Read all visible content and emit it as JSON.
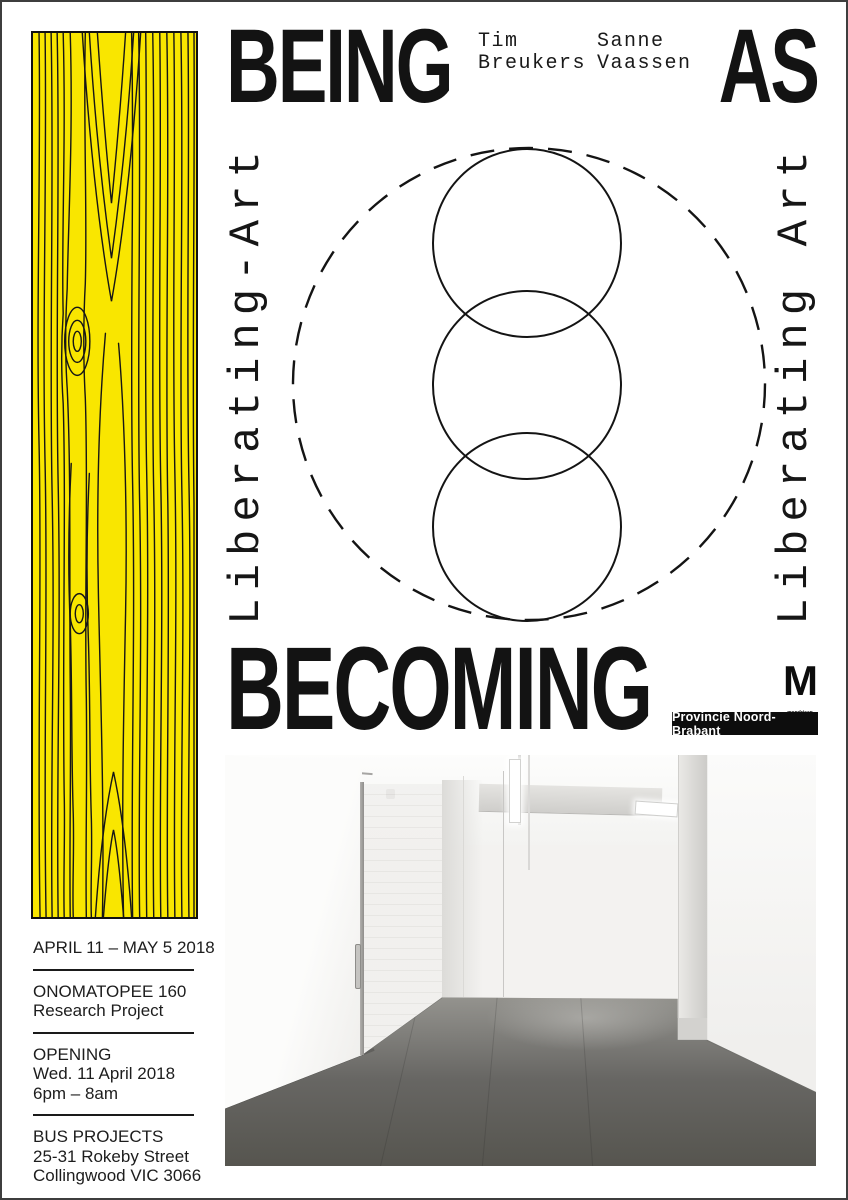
{
  "poster": {
    "title_top_left": "BEING",
    "title_top_right": "AS",
    "title_bottom": "BECOMING",
    "artists": [
      {
        "first": "Tim",
        "last": "Breukers"
      },
      {
        "first": "Sanne",
        "last": "Vaassen"
      }
    ],
    "vertical_left": "Liberating-Art",
    "vertical_right": "Liberating Art",
    "logos": {
      "mondriaan_m": "M",
      "mondriaan_line1": "mondriaan",
      "mondriaan_line2": "fonds",
      "provincie": "Provincie Noord-Brabant"
    },
    "info": {
      "dates": "APRIL 11 – MAY 5 2018",
      "project_line1": "ONOMATOPEE 160",
      "project_line2": "Research Project",
      "opening_label": "OPENING",
      "opening_date": "Wed. 11 April 2018",
      "opening_time": "6pm – 8am",
      "venue_name": "BUS PROJECTS",
      "venue_address1": "25-31 Rokeby Street",
      "venue_address2": "Collingwood VIC 3066"
    },
    "colors": {
      "wood_yellow": "#f9e600",
      "ink": "#131313"
    }
  }
}
